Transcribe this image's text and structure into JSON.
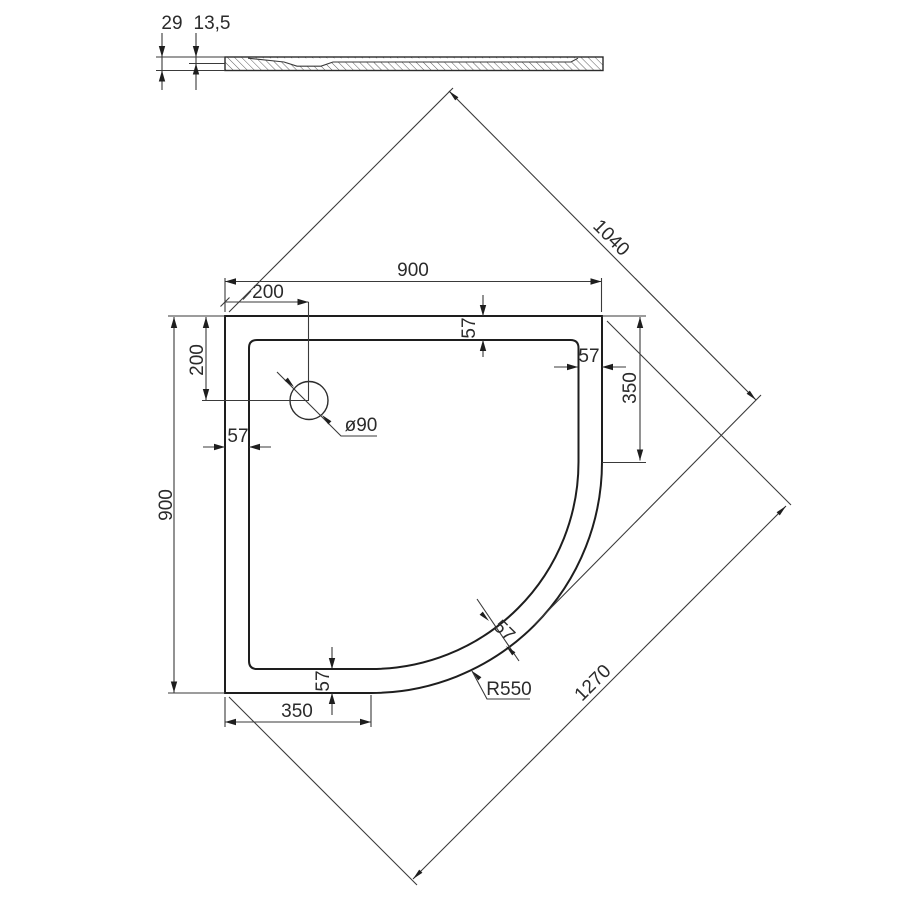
{
  "drawing": {
    "type": "technical-drawing-quadrant-shower-tray",
    "line_color": "#1e1e1e",
    "background": "#ffffff"
  },
  "section_view": {
    "total_height": "29",
    "depth_to_floor": "13,5"
  },
  "plan_view": {
    "overall_width": "900",
    "overall_depth": "900",
    "drain_offset_left": "200",
    "drain_offset_top": "200",
    "drain_diameter": "ø90",
    "rim_width_top": "57",
    "rim_width_right": "57",
    "rim_width_left": "57",
    "rim_width_bottom": "57",
    "rim_width_arc": "57",
    "corner_radius": "R550",
    "arc_offset_right": "350",
    "arc_offset_bottom": "350",
    "diagonal_corner_to_arc": "1040",
    "diagonal_overall": "1270"
  }
}
